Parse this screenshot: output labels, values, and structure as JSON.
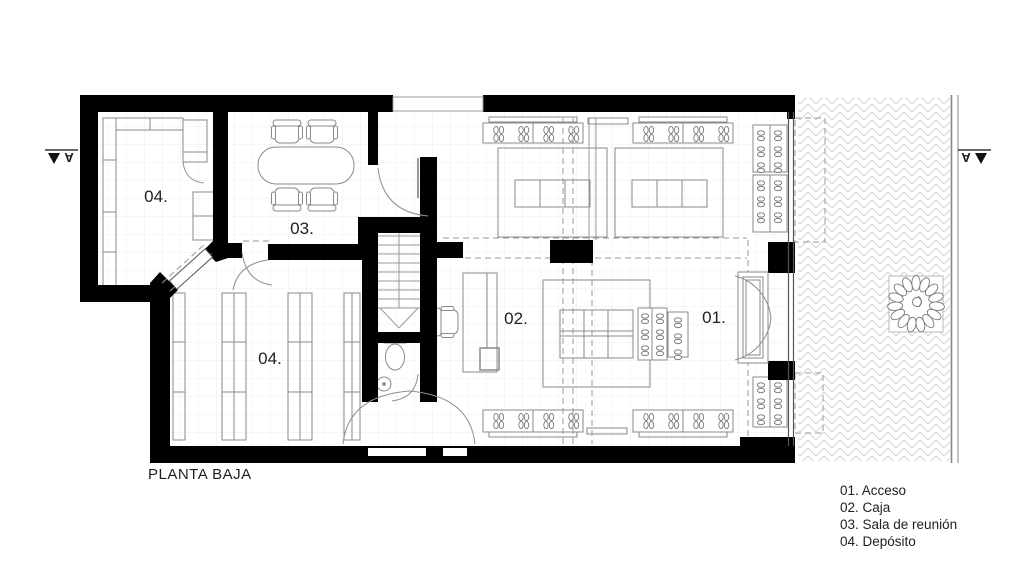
{
  "title": "PLANTA BAJA",
  "rooms": {
    "access_label": "01.",
    "cashier_label": "02.",
    "meeting_label": "03.",
    "storage_upper_label": "04.",
    "storage_lower_label": "04."
  },
  "legend": {
    "items": [
      {
        "text": "01. Acceso"
      },
      {
        "text": "02. Caja"
      },
      {
        "text": "03. Sala de reunión"
      },
      {
        "text": "04. Depósito"
      }
    ]
  },
  "section_markers": {
    "left_letter": "A",
    "right_letter": "A"
  },
  "colors": {
    "walls": "#000000",
    "furniture_line": "#8a8a8a",
    "dashed_line": "#9a9a9a",
    "grid_line": "#ececec",
    "hatch_line": "#d4d4d4",
    "text": "#1f1f1f"
  }
}
